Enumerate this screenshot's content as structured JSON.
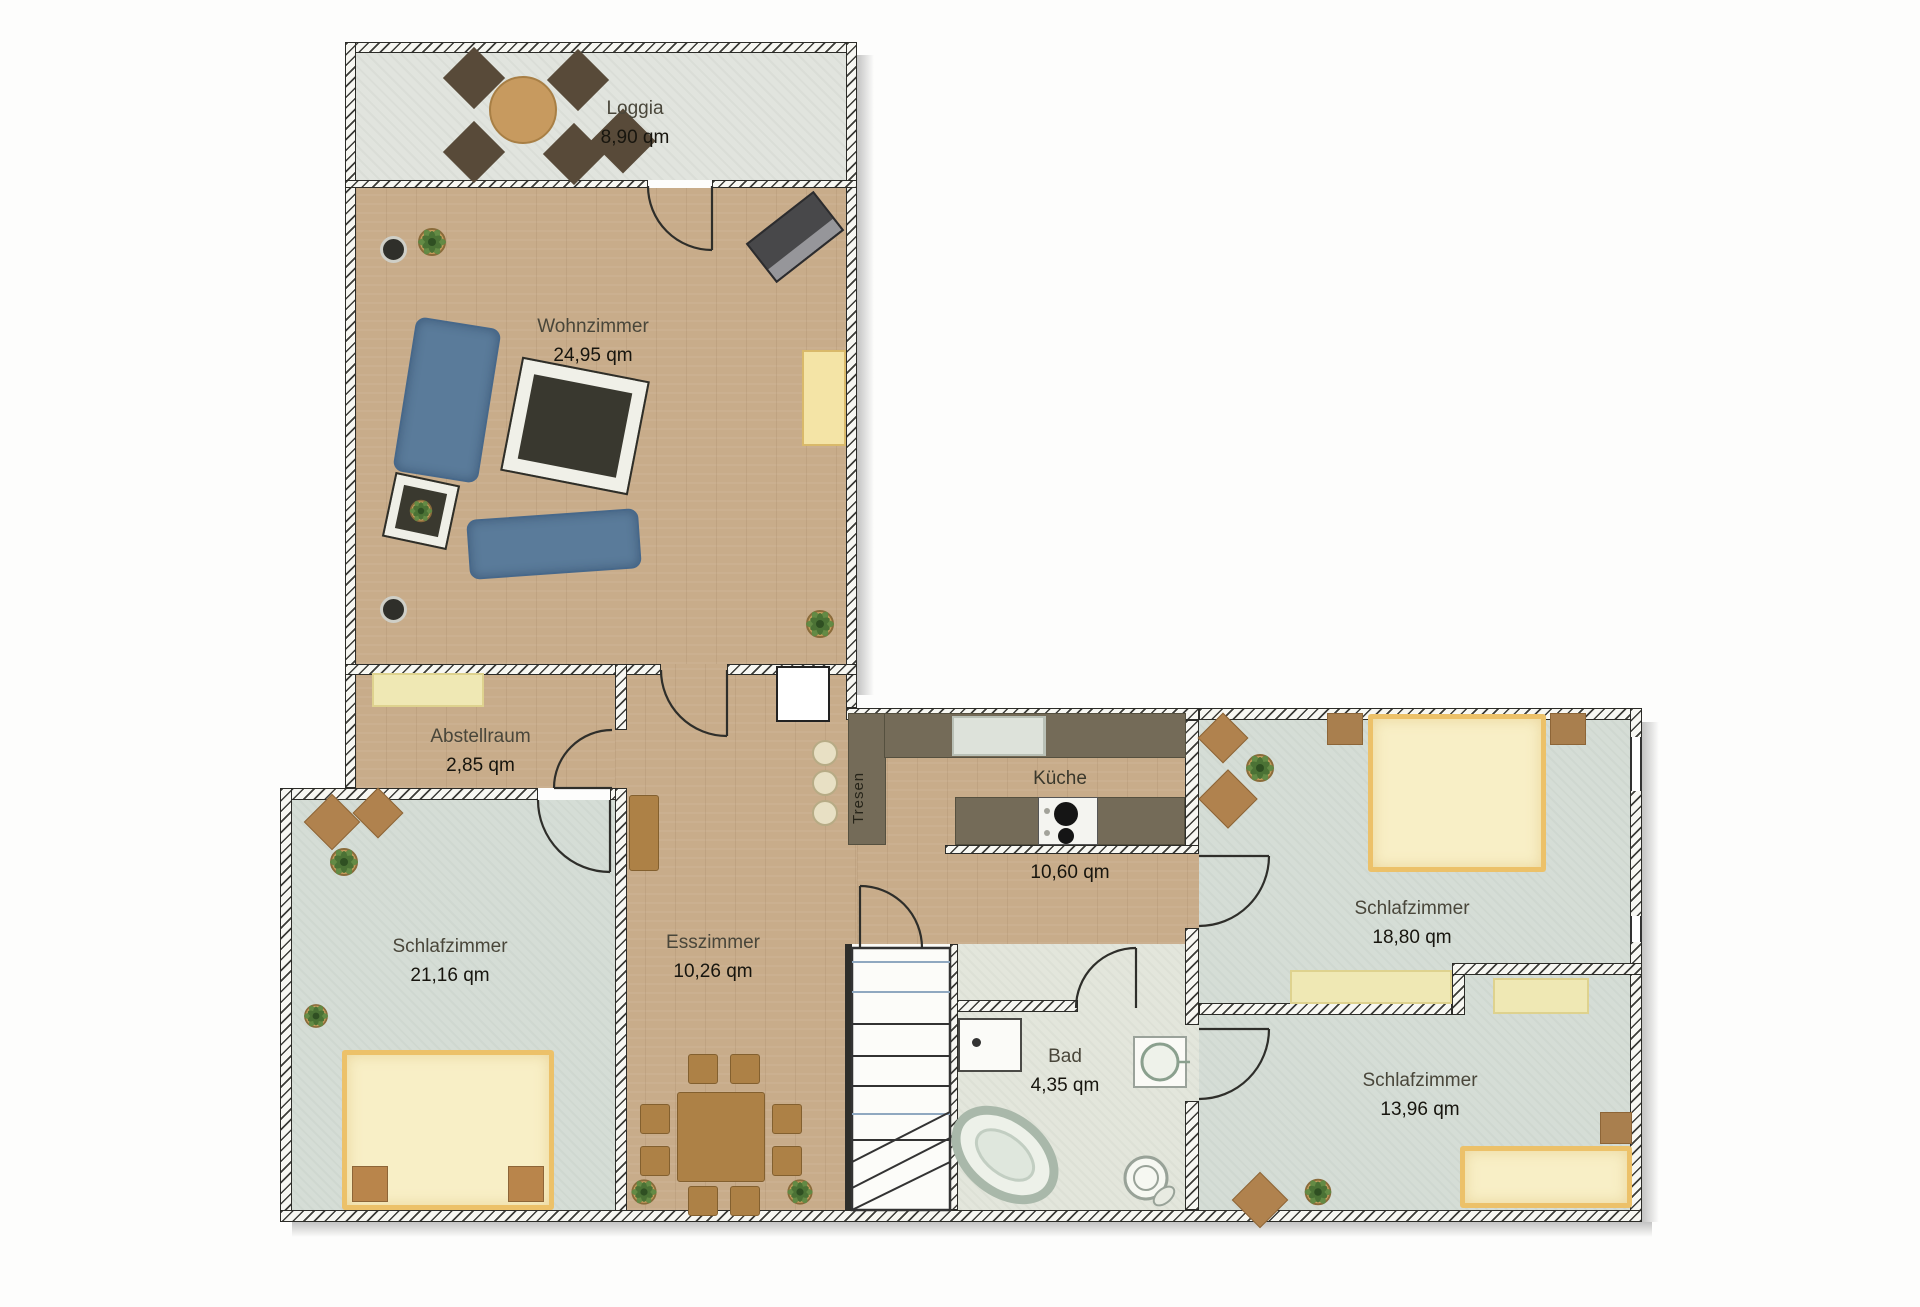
{
  "document": {
    "type": "floor-plan",
    "language": "de",
    "unit": "qm"
  },
  "rooms": {
    "loggia": {
      "name": "Loggia",
      "area": "8,90 qm"
    },
    "wohnzimmer": {
      "name": "Wohnzimmer",
      "area": "24,95 qm"
    },
    "abstellraum": {
      "name": "Abstellraum",
      "area": "2,85 qm"
    },
    "schlafzimmer_links": {
      "name": "Schlafzimmer",
      "area": "21,16 qm"
    },
    "esszimmer": {
      "name": "Esszimmer",
      "area": "10,26 qm"
    },
    "kueche": {
      "name": "Küche",
      "area": "10,60 qm"
    },
    "bad": {
      "name": "Bad",
      "area": "4,35 qm"
    },
    "schlafzimmer_oben_rechts": {
      "name": "Schlafzimmer",
      "area": "18,80 qm"
    },
    "schlafzimmer_unten_rechts": {
      "name": "Schlafzimmer",
      "area": "13,96 qm"
    }
  },
  "labels": {
    "tresen": "Tresen"
  },
  "colors": {
    "floor_wood": "#c8ac8a",
    "floor_loggia": "#e1e4de",
    "floor_bedroom": "#d5ddd6",
    "floor_bad": "#e3e6dc",
    "sofa_blue": "#5a7b9a",
    "counter_dark": "#746b58",
    "bed_yellow": "#f8efc6",
    "bed_trim": "#ecc169",
    "dresser_yellow": "#efe8b4",
    "wood_brown": "#ad8146",
    "chair_dark_brown": "#584a39",
    "rug_dark": "#39382f",
    "plant_green": "#5f8a44",
    "wall_line": "#2c2c28"
  },
  "furniture": {
    "loggia": [
      "round-table",
      "chair",
      "chair",
      "chair",
      "chair",
      "chair"
    ],
    "wohnzimmer": [
      "sofa",
      "sofa",
      "rug",
      "side-table",
      "tv",
      "plant",
      "plant",
      "sideboard",
      "floor-lamp",
      "floor-lamp"
    ],
    "abstellraum": [
      "sideboard"
    ],
    "esszimmer": [
      "dining-table",
      "chairs-8",
      "sideboard",
      "bar-stools-3",
      "plant",
      "plant",
      "chimney"
    ],
    "kueche": [
      "counter-with-sink",
      "counter-with-cooktop",
      "bar-counter"
    ],
    "bad": [
      "washing-machine",
      "washbasin",
      "bathtub",
      "toilet"
    ],
    "schlafzimmer_links": [
      "double-bed",
      "nightstand",
      "nightstand",
      "plant",
      "plant"
    ],
    "schlafzimmer_oben_rechts": [
      "double-bed",
      "nightstand",
      "nightstand",
      "dresser",
      "plant"
    ],
    "schlafzimmer_unten_rechts": [
      "bed",
      "dresser",
      "nightstand",
      "plant"
    ],
    "treppenhaus": [
      "staircase"
    ]
  }
}
